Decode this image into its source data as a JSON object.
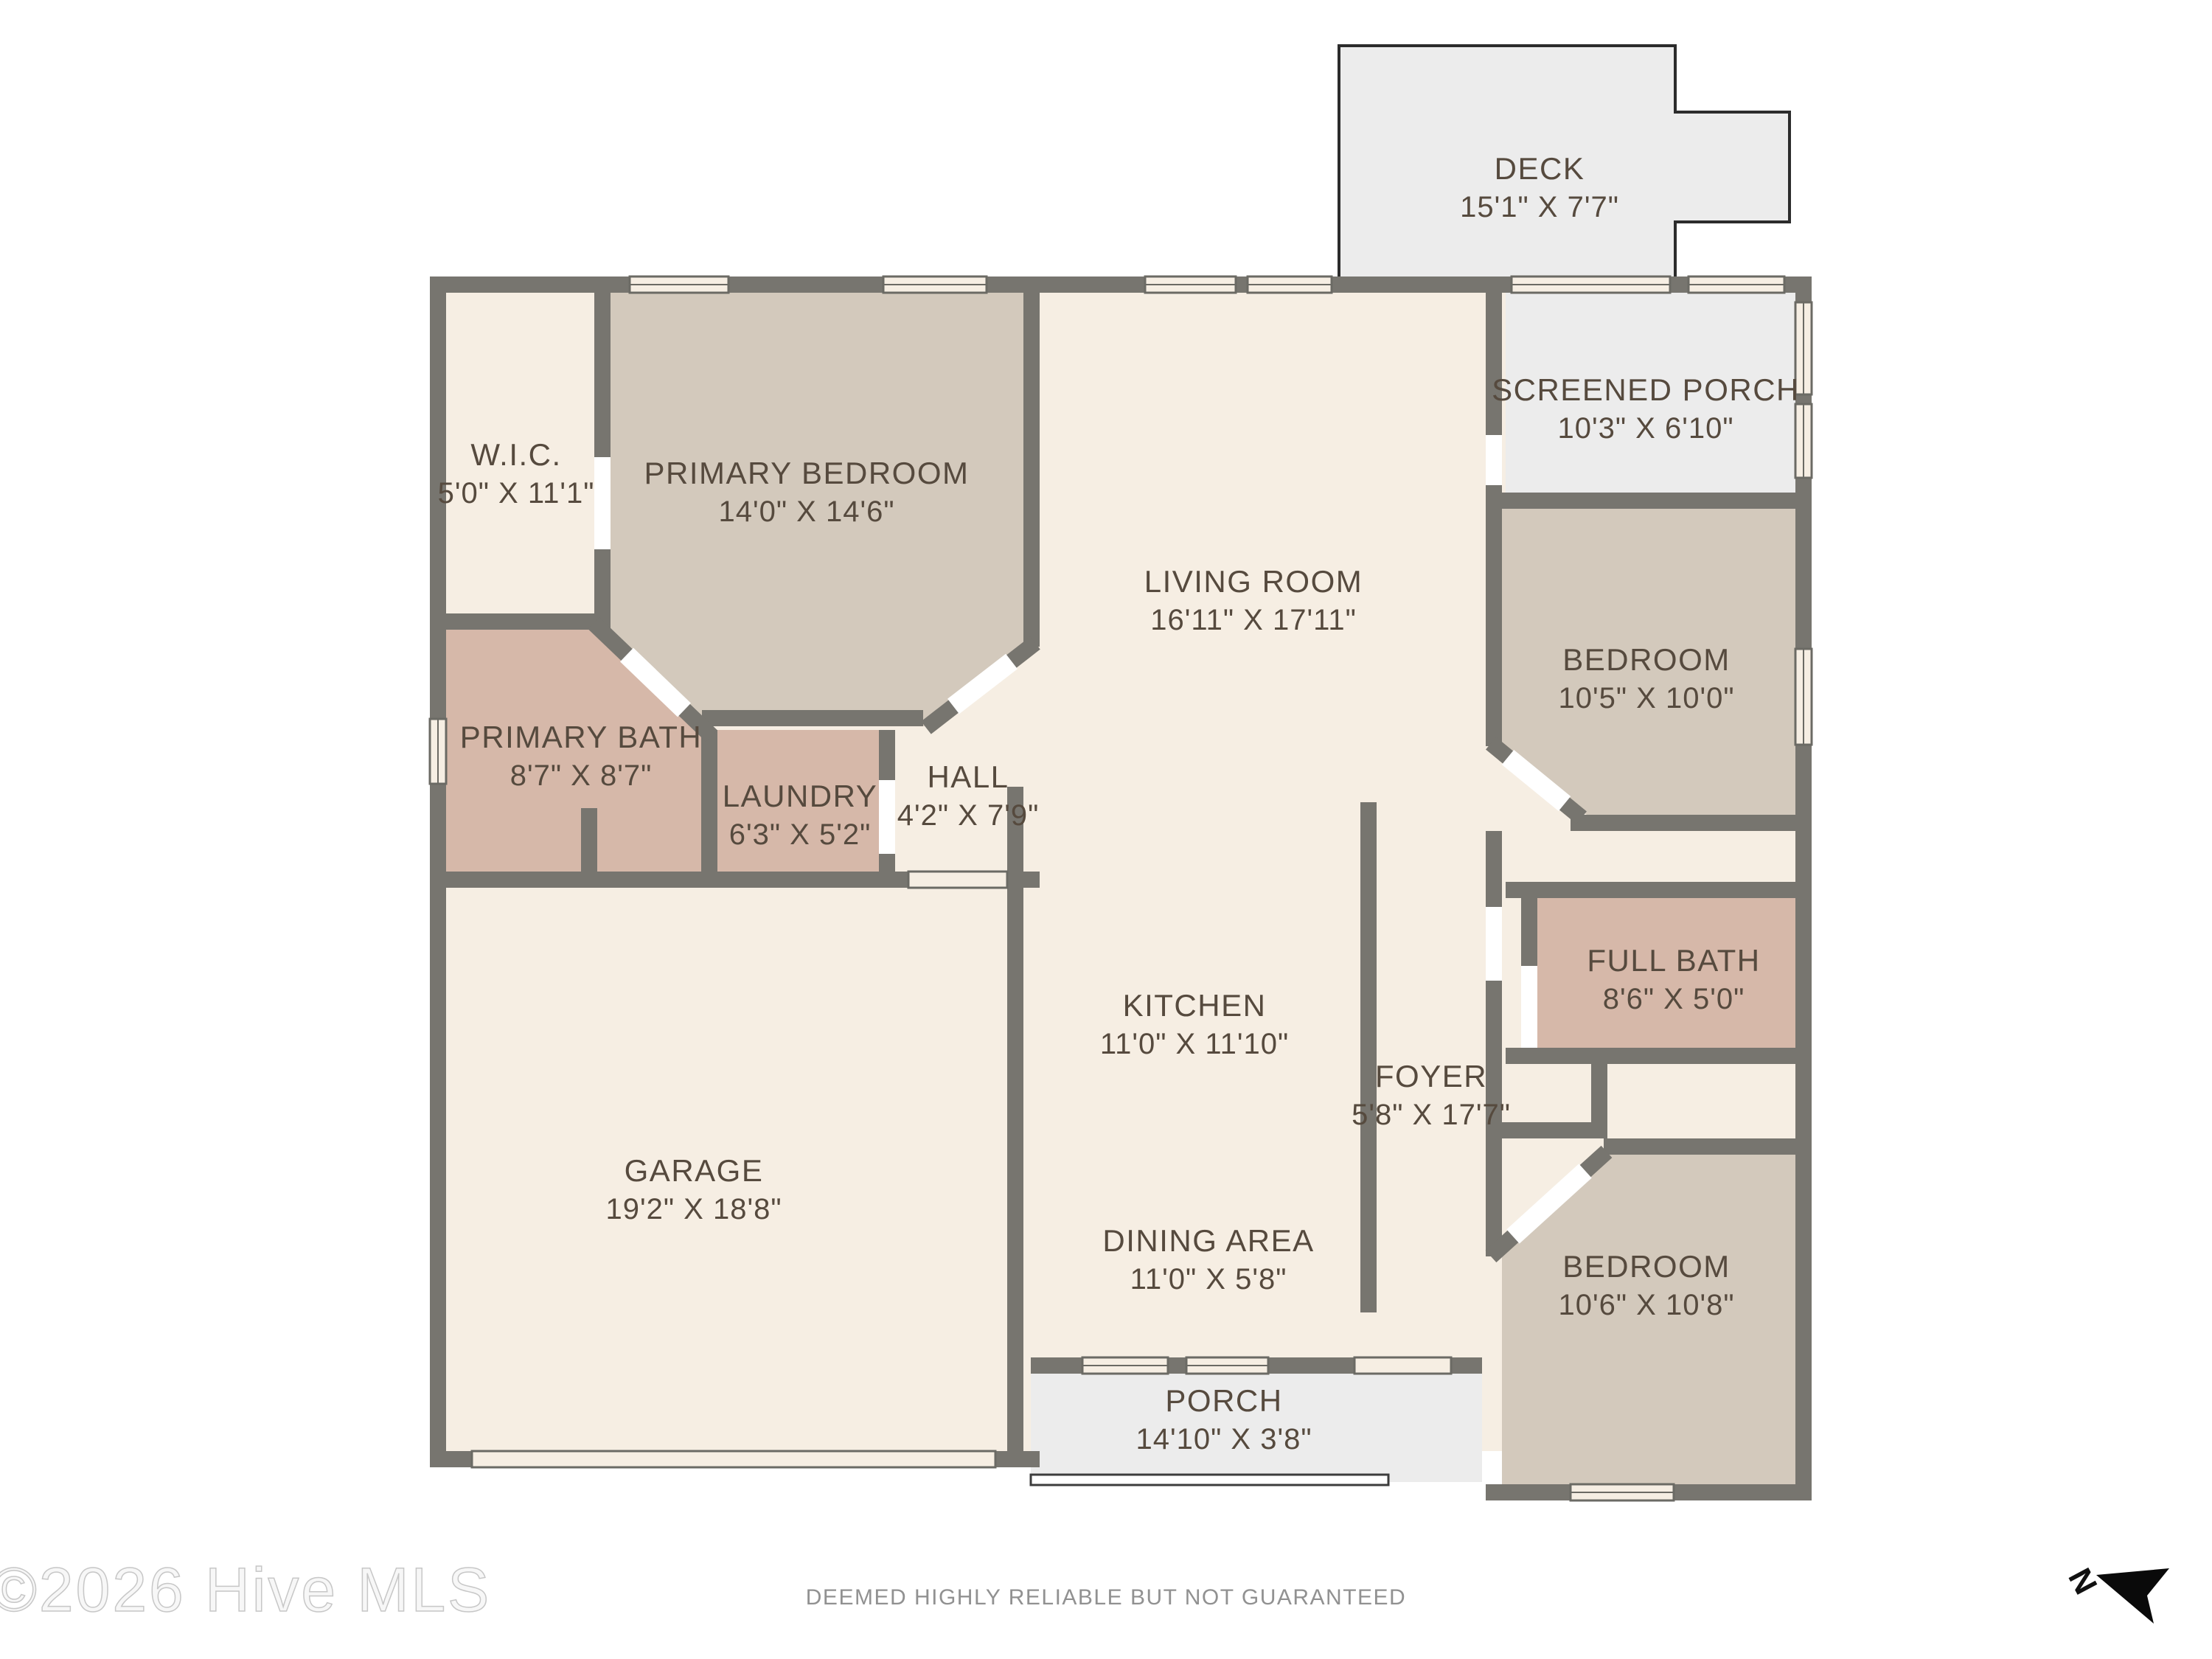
{
  "meta": {
    "watermark": "©2026 Hive MLS",
    "footer_disclaimer": "DEEMED HIGHLY RELIABLE BUT NOT GUARANTEED",
    "north_label": "N"
  },
  "colors": {
    "room_cream": "#f6eee3",
    "bedroom_tan": "#d3c9bc",
    "bath_mauve": "#d6b8a9",
    "porch_gray": "#ececec",
    "wall_gray": "#77756f",
    "label_text": "#564a3e",
    "footer_text": "#919191",
    "watermark_outline": "#c7c7c7",
    "north_black": "#0a0a0a"
  },
  "rooms": {
    "deck": {
      "name": "DECK",
      "dims": "15'1\" X 7'7\""
    },
    "screened_porch": {
      "name": "SCREENED PORCH",
      "dims": "10'3\" X 6'10\""
    },
    "wic": {
      "name": "W.I.C.",
      "dims": "5'0\" X 11'1\""
    },
    "primary_bedroom": {
      "name": "PRIMARY BEDROOM",
      "dims": "14'0\" X 14'6\""
    },
    "living_room": {
      "name": "LIVING ROOM",
      "dims": "16'11\" X 17'11\""
    },
    "bedroom_right": {
      "name": "BEDROOM",
      "dims": "10'5\" X 10'0\""
    },
    "primary_bath": {
      "name": "PRIMARY BATH",
      "dims": "8'7\" X 8'7\""
    },
    "laundry": {
      "name": "LAUNDRY",
      "dims": "6'3\" X 5'2\""
    },
    "hall": {
      "name": "HALL",
      "dims": "4'2\" X 7'9\""
    },
    "full_bath": {
      "name": "FULL BATH",
      "dims": "8'6\" X 5'0\""
    },
    "kitchen": {
      "name": "KITCHEN",
      "dims": "11'0\" X 11'10\""
    },
    "foyer": {
      "name": "FOYER",
      "dims": "5'8\" X 17'7\""
    },
    "garage": {
      "name": "GARAGE",
      "dims": "19'2\" X 18'8\""
    },
    "dining_area": {
      "name": "DINING AREA",
      "dims": "11'0\" X 5'8\""
    },
    "bedroom_bottom": {
      "name": "BEDROOM",
      "dims": "10'6\" X 10'8\""
    },
    "porch": {
      "name": "PORCH",
      "dims": "14'10\" X 3'8\""
    }
  }
}
